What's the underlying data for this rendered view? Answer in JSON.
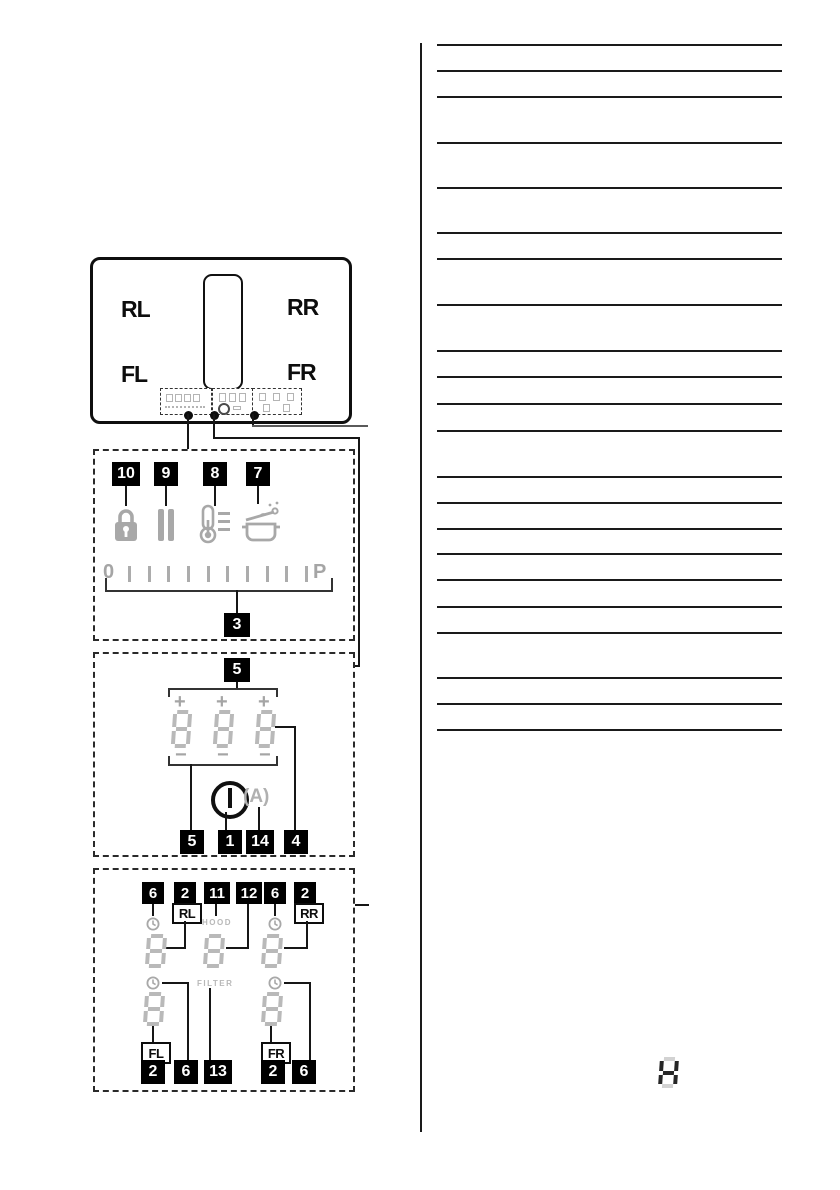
{
  "hob": {
    "zone_rl": "RL",
    "zone_rr": "RR",
    "zone_fl": "FL",
    "zone_fr": "FR"
  },
  "box1": {
    "tags": [
      "10",
      "9",
      "8",
      "7"
    ],
    "slider": {
      "start_label": "0",
      "end_label": "P",
      "tick_count": 10
    },
    "slider_tag": "3"
  },
  "box2": {
    "top_tag": "5",
    "plus": "+",
    "minus": "−",
    "display_digit": "8",
    "auto_label": "(A)",
    "bottom_tags": [
      "5",
      "1",
      "14",
      "4"
    ]
  },
  "box3": {
    "top_tags": [
      "6",
      "2",
      "11",
      "12",
      "6",
      "2"
    ],
    "zone_rl": "RL",
    "zone_rr": "RR",
    "zone_fl": "FL",
    "zone_fr": "FR",
    "hood_label": "HOOD",
    "filter_label": "FILTER",
    "display_digit": "8",
    "bottom_tags": [
      "2",
      "6",
      "13",
      "2",
      "6"
    ]
  },
  "right_column": {
    "ruled_line_x": 437,
    "ruled_line_width": 345,
    "ruled_line_ys": [
      45,
      71,
      97,
      143,
      188,
      233,
      259,
      305,
      351,
      377,
      404,
      431,
      477,
      503,
      529,
      554,
      580,
      607,
      633,
      678,
      704,
      730
    ],
    "seg_char": "H"
  },
  "colors": {
    "tag_bg": "#000000",
    "tag_fg": "#ffffff",
    "icon_gray": "#a8a8a8",
    "seg_gray": "#b9b9b9",
    "line": "#1a1a1a"
  }
}
